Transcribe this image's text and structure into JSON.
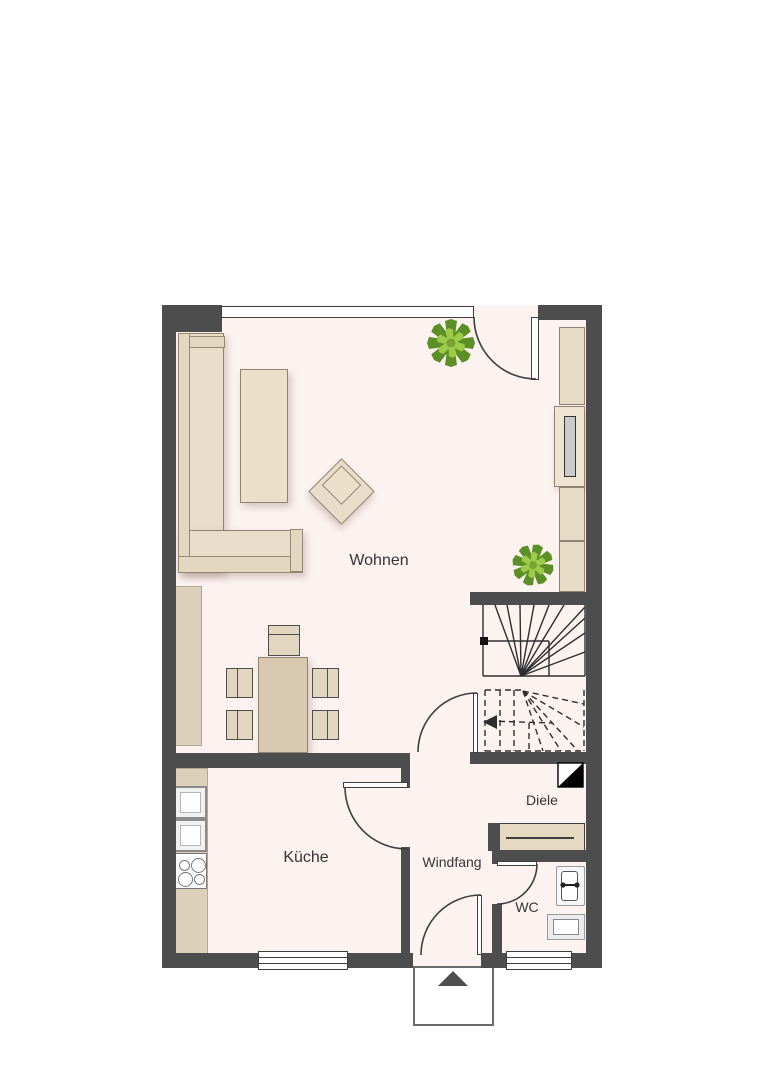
{
  "rooms": {
    "wohnen": {
      "label": "Wohnen"
    },
    "kueche": {
      "label": "Küche"
    },
    "windfang": {
      "label": "Windfang"
    },
    "diele": {
      "label": "Diele"
    },
    "wc": {
      "label": "WC"
    }
  },
  "colors": {
    "wall": "#4d4d4d",
    "floor": "#fcf2f0",
    "outside": "#ffffff",
    "furniture_fill": "#e8ddc9",
    "furniture_border": "#8f8472",
    "counter_fill": "#ddd0ba",
    "table_fill": "#d8c9b0",
    "drawing_line": "#3f3f3f",
    "plant_green_dark": "#5c8f25",
    "plant_green_light": "#9ccb49"
  },
  "icons": {
    "plant": "plant-icon",
    "entrance_arrow": "▲",
    "level_marker": "◪"
  }
}
